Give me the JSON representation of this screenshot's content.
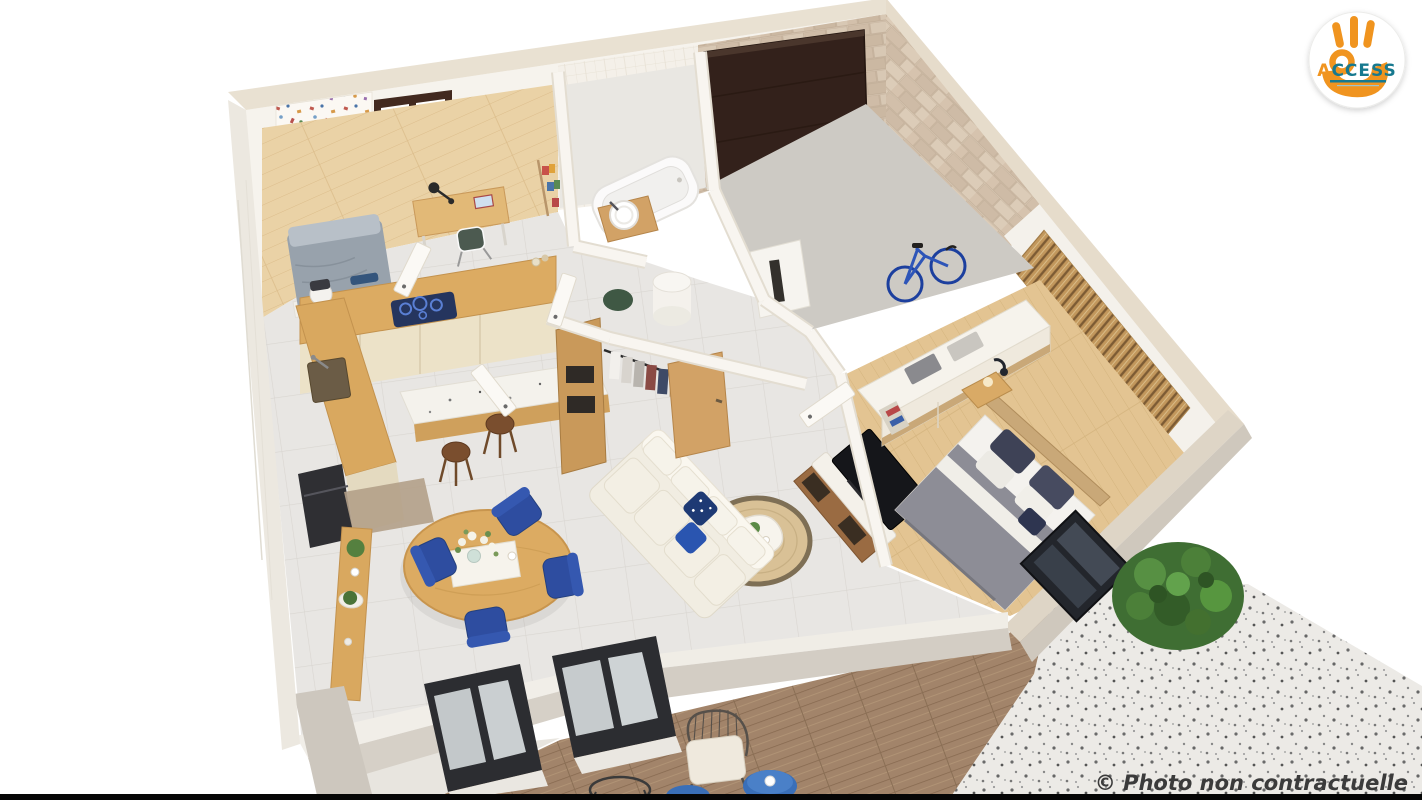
{
  "meta": {
    "width": 1422,
    "height": 800
  },
  "logo": {
    "brand_first_letter": "A",
    "brand_rest": "CCESS",
    "icon": "ok-hand-icon",
    "circle_color": "#ffffff",
    "hand_color": "#f0941f",
    "text_primary_color": "#f0941f",
    "text_secondary_color": "#17798f"
  },
  "caption": {
    "text": "© Photo non contractuelle",
    "color": "#3b3b3b"
  },
  "palette": {
    "background": "#ffffff",
    "wall_white": "#f6f3ed",
    "wall_stone": "#e9e1d2",
    "concrete": "#d4cec5",
    "brick_beige": "#d0bfab",
    "garage_floor": "#cdcac4",
    "tile_floor": "#e8e6e3",
    "wood_floor": "#ead2a6",
    "counter_wood": "#d9a85f",
    "cabinet_cream": "#ece2c8",
    "accent_blue": "#2e4da0",
    "duvet_gray": "#8d8d96",
    "jute": "#d9c196",
    "deck_wood": "#a2846a",
    "plant_green": "#4d7c3a",
    "garage_door_brown": "#33211b",
    "frame_dark": "#2c2d31",
    "bottom_bar": "#060606"
  },
  "scene": {
    "rooms": [
      "bedroom-office",
      "bathroom",
      "garage",
      "hallway",
      "walk-in-closet",
      "master-bedroom",
      "kitchen",
      "dining-area",
      "living-room",
      "terrace",
      "patio"
    ],
    "objects": [
      "single-bed",
      "desk",
      "desk-chair",
      "desk-lamp",
      "ladder-shelf",
      "patterned-wallpaper",
      "window",
      "kitchen-counter",
      "induction-cooktop",
      "kitchen-sink",
      "coffee-machine",
      "kitchen-island",
      "bar-stool",
      "oven",
      "round-dining-table",
      "dining-chair",
      "flower-vase",
      "console-table",
      "potted-plant",
      "doormat",
      "corner-sofa",
      "throw-pillow",
      "jute-rug",
      "coffee-table",
      "tv",
      "tv-stand",
      "double-bed",
      "pillow",
      "duvet",
      "headboard",
      "nightstand",
      "bedside-lamp",
      "wardrobe",
      "folded-towels",
      "wood-slat-wall",
      "bathtub",
      "vessel-sink",
      "bathroom-window",
      "hanging-clothes",
      "water-heater",
      "washing-nook",
      "interior-door",
      "garage-door",
      "bicycle",
      "brick-wall",
      "glass-sliding-door",
      "wooden-deck",
      "outdoor-chair",
      "outdoor-side-table",
      "gravel-patio",
      "bush"
    ]
  }
}
